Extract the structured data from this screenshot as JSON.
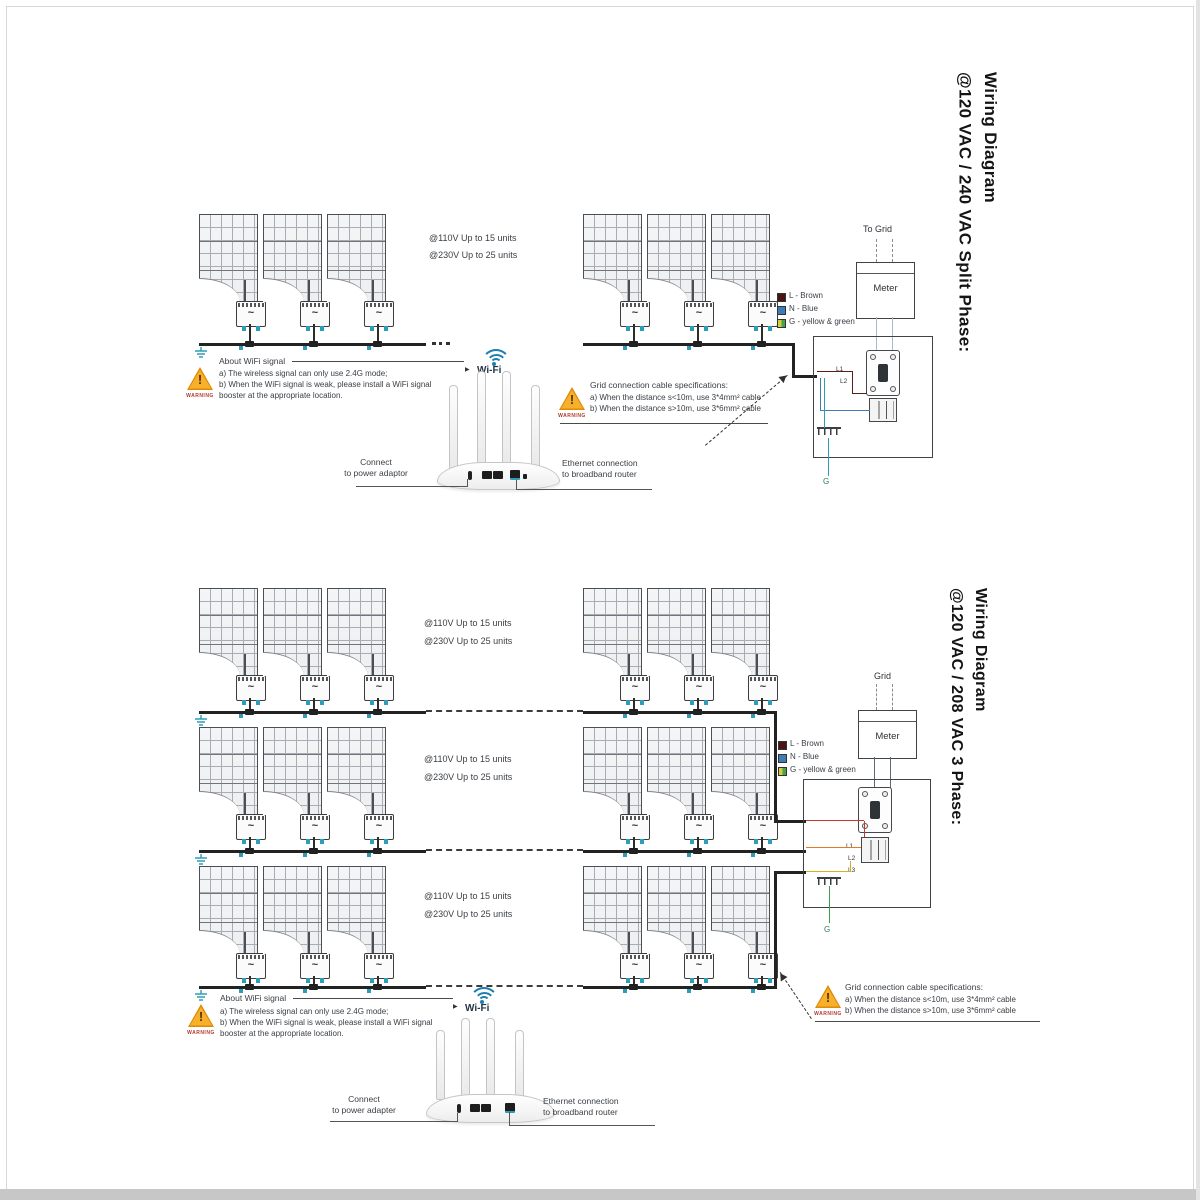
{
  "colors": {
    "trunk": "#222222",
    "teal_accent": "#2e9db5",
    "wifi_arc_blue": "#1c7fae",
    "warning_fill": "#f6b02c",
    "warning_border": "#e08a06",
    "legend_brown": "#4a1510",
    "legend_blue": "#3e7cb8",
    "legend_yellow": "#d3cf3a",
    "legend_green": "#4aa14a",
    "wire_red": "#c23b2e",
    "wire_orange": "#e07b2a",
    "wire_yellow": "#d4af1e",
    "wire_green": "#3f9e4e"
  },
  "top": {
    "title": [
      "Wiring Diagram",
      "@120 VAC / 240 VAC Split Phase:"
    ],
    "capacity": [
      "@110V Up to 15 units",
      "@230V Up to 25 units"
    ],
    "wifi_warning": {
      "badge": "WARNING",
      "title": "About WiFi signal",
      "lines": [
        "a) The wireless signal can only use 2.4G mode;",
        "b) When the WiFi signal is weak, please install a WiFi signal",
        "booster at the appropriate location."
      ]
    },
    "cable_warning": {
      "badge": "WARNING",
      "title": "Grid connection cable specifications:",
      "lines": [
        "a) When the distance s<10m, use 3*4mm² cable",
        "b) When the distance s>10m, use 3*6mm² cable"
      ]
    },
    "wifi_label": "Wi-Fi",
    "power_label": [
      "Connect",
      "to power adaptor"
    ],
    "ethernet_label": [
      "Ethernet connection",
      "to broadband router"
    ],
    "grid_label": "To Grid",
    "meter_label": "Meter",
    "legend": [
      {
        "label": "L - Brown",
        "color": "#4a1510"
      },
      {
        "label": "N - Blue",
        "color": "#3e7cb8"
      },
      {
        "label": "G - yellow & green",
        "color": "#d3cf3a"
      }
    ],
    "phase_labels": [
      "L1",
      "L2"
    ],
    "ground_label": "G"
  },
  "bottom": {
    "title": [
      "Wiring Diagram",
      "@120 VAC / 208 VAC 3 Phase:"
    ],
    "capacity": [
      "@110V Up to 15 units",
      "@230V Up to 25 units"
    ],
    "wifi_warning": {
      "badge": "WARNING",
      "title": "About WiFi signal",
      "lines": [
        "a) The wireless signal can only use 2.4G mode;",
        "b) When the WiFi signal is weak, please install a WiFi signal",
        "booster at the appropriate location."
      ]
    },
    "cable_warning": {
      "badge": "WARNING",
      "title": "Grid connection cable specifications:",
      "lines": [
        "a) When the distance s<10m, use 3*4mm² cable",
        "b) When the distance s>10m, use 3*6mm² cable"
      ]
    },
    "wifi_label": "Wi-Fi",
    "power_label": [
      "Connect",
      "to power adapter"
    ],
    "ethernet_label": [
      "Ethernet connection",
      "to broadband router"
    ],
    "grid_label": "Grid",
    "meter_label": "Meter",
    "legend": [
      {
        "label": "L - Brown",
        "color": "#4a1510"
      },
      {
        "label": "N - Blue",
        "color": "#3e7cb8"
      },
      {
        "label": "G - yellow & green",
        "color": "#d3cf3a"
      }
    ],
    "phase_labels": [
      "L1",
      "L2",
      "L3"
    ],
    "ground_label": "G"
  }
}
